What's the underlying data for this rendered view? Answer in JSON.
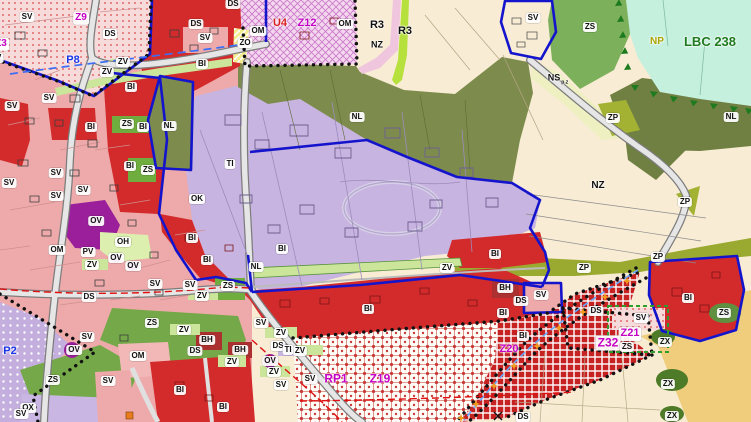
{
  "map": {
    "palette": {
      "residential_bi_red": "#d32b2b",
      "dark_red_bh": "#ad3030",
      "mixed_sv_pink": "#eeaaaa",
      "civic_ov_purple": "#9b1f9b",
      "technical_ti_lavender": "#c8b4e0",
      "forest_nl_olive": "#7d8c4c",
      "forest_nl_dark": "#6f8042",
      "greenery_zs": "#74a848",
      "park_zv_lightgreen": "#cbe69b",
      "agriculture_nz_cream": "#f8ecd4",
      "nature_np_mint": "#c6f0de",
      "zp_yellowgreen": "#9aaa30",
      "ns_pale_yellow": "#eef0c2",
      "orchard_tan": "#f0cd7c",
      "zx_dark_green": "#4e7b28",
      "boundary_blue": "#1414cc",
      "trail_star_orange": "#ef9b1d",
      "red_dash_line": "#e01010",
      "label_magenta": "#c400c4",
      "label_blue": "#1a35e6",
      "lbc_green": "#1e7a1e"
    },
    "trail_stars": [
      [
        627,
        281
      ],
      [
        605,
        297
      ],
      [
        583,
        312
      ],
      [
        559,
        328
      ],
      [
        537,
        346
      ],
      [
        514,
        366
      ],
      [
        494,
        386
      ],
      [
        476,
        404
      ],
      [
        461,
        418
      ]
    ],
    "labels": [
      {
        "t": "SV",
        "x": 27,
        "y": 17
      },
      {
        "t": "Z9",
        "x": 81,
        "y": 18,
        "c": "m",
        "fs": 10
      },
      {
        "t": "DS",
        "x": 233,
        "y": 4
      },
      {
        "t": "DS",
        "x": 196,
        "y": 24
      },
      {
        "t": "DS",
        "x": 110,
        "y": 34
      },
      {
        "t": "SV",
        "x": 205,
        "y": 38
      },
      {
        "t": "Z3",
        "x": 1,
        "y": 44,
        "c": "m",
        "fs": 10
      },
      {
        "t": "SV",
        "x": -4,
        "y": 58
      },
      {
        "t": "P8",
        "x": 73,
        "y": 61,
        "c": "b",
        "fs": 11,
        "box": false
      },
      {
        "t": "ZV",
        "x": 123,
        "y": 62
      },
      {
        "t": "ZV",
        "x": 107,
        "y": 72
      },
      {
        "t": "BI",
        "x": 202,
        "y": 64
      },
      {
        "t": "OM",
        "x": 258,
        "y": 31
      },
      {
        "t": "U4",
        "x": 280,
        "y": 24,
        "c": "r",
        "fs": 11,
        "box": false
      },
      {
        "t": "Z12",
        "x": 307,
        "y": 24,
        "c": "m",
        "fs": 11,
        "box": false
      },
      {
        "t": "OM",
        "x": 345,
        "y": 24
      },
      {
        "t": "ZO",
        "x": 245,
        "y": 43
      },
      {
        "t": "R3",
        "x": 377,
        "y": 26,
        "fs": 11,
        "box": false
      },
      {
        "t": "R3",
        "x": 405,
        "y": 32,
        "fs": 11,
        "box": false
      },
      {
        "t": "NZ",
        "x": 377,
        "y": 45,
        "fs": 9,
        "box": false
      },
      {
        "t": "SV",
        "x": 533,
        "y": 18
      },
      {
        "t": "ZS",
        "x": 590,
        "y": 27
      },
      {
        "t": "NP",
        "x": 657,
        "y": 42,
        "c": "y",
        "fs": 10,
        "box": false
      },
      {
        "t": "LBC 238",
        "x": 710,
        "y": 42,
        "c": "g",
        "fs": 13,
        "box": false
      },
      {
        "t": "NS",
        "x": 558,
        "y": 79,
        "fs": 9,
        "box": false,
        "sub": "p.z"
      },
      {
        "t": "BI",
        "x": 131,
        "y": 87
      },
      {
        "t": "SV",
        "x": 49,
        "y": 98
      },
      {
        "t": "SV",
        "x": 12,
        "y": 106
      },
      {
        "t": "BI",
        "x": 91,
        "y": 127
      },
      {
        "t": "ZS",
        "x": 127,
        "y": 124
      },
      {
        "t": "BI",
        "x": 143,
        "y": 127
      },
      {
        "t": "NL",
        "x": 169,
        "y": 126
      },
      {
        "t": "NL",
        "x": 357,
        "y": 117
      },
      {
        "t": "ZP",
        "x": 613,
        "y": 118
      },
      {
        "t": "NL",
        "x": 731,
        "y": 117
      },
      {
        "t": "BI",
        "x": 130,
        "y": 166
      },
      {
        "t": "ZS",
        "x": 148,
        "y": 170
      },
      {
        "t": "TI",
        "x": 230,
        "y": 164
      },
      {
        "t": "SV",
        "x": 56,
        "y": 173
      },
      {
        "t": "SV",
        "x": 9,
        "y": 183
      },
      {
        "t": "SV",
        "x": 83,
        "y": 190
      },
      {
        "t": "SV",
        "x": 56,
        "y": 196
      },
      {
        "t": "OK",
        "x": 197,
        "y": 199
      },
      {
        "t": "NZ",
        "x": 598,
        "y": 186,
        "fs": 10,
        "box": false
      },
      {
        "t": "ZP",
        "x": 685,
        "y": 202
      },
      {
        "t": "OV",
        "x": 96,
        "y": 221
      },
      {
        "t": "BI",
        "x": 192,
        "y": 238
      },
      {
        "t": "OH",
        "x": 123,
        "y": 242
      },
      {
        "t": "OM",
        "x": 57,
        "y": 250
      },
      {
        "t": "PV",
        "x": 88,
        "y": 252
      },
      {
        "t": "BI",
        "x": 282,
        "y": 249
      },
      {
        "t": "BI",
        "x": 495,
        "y": 254
      },
      {
        "t": "ZP",
        "x": 658,
        "y": 257
      },
      {
        "t": "BI",
        "x": 207,
        "y": 260
      },
      {
        "t": "ZV",
        "x": 92,
        "y": 265
      },
      {
        "t": "OV",
        "x": 116,
        "y": 258
      },
      {
        "t": "OV",
        "x": 133,
        "y": 266
      },
      {
        "t": "NL",
        "x": 256,
        "y": 267
      },
      {
        "t": "ZV",
        "x": 447,
        "y": 268
      },
      {
        "t": "ZP",
        "x": 584,
        "y": 268
      },
      {
        "t": "ZV",
        "x": 202,
        "y": 296
      },
      {
        "t": "DS",
        "x": 89,
        "y": 297
      },
      {
        "t": "SV",
        "x": 155,
        "y": 284
      },
      {
        "t": "SV",
        "x": 190,
        "y": 285
      },
      {
        "t": "ZS",
        "x": 228,
        "y": 286
      },
      {
        "t": "BH",
        "x": 505,
        "y": 288
      },
      {
        "t": "SV",
        "x": 541,
        "y": 295
      },
      {
        "t": "BI",
        "x": 688,
        "y": 298
      },
      {
        "t": "DS",
        "x": 521,
        "y": 301
      },
      {
        "t": "BI",
        "x": 368,
        "y": 309
      },
      {
        "t": "DS",
        "x": 596,
        "y": 311
      },
      {
        "t": "BI",
        "x": 503,
        "y": 313
      },
      {
        "t": "ZS",
        "x": 724,
        "y": 313
      },
      {
        "t": "SV",
        "x": 641,
        "y": 318
      },
      {
        "t": "SV",
        "x": 261,
        "y": 323
      },
      {
        "t": "ZS",
        "x": 152,
        "y": 323
      },
      {
        "t": "ZV",
        "x": 184,
        "y": 330
      },
      {
        "t": "ZV",
        "x": 281,
        "y": 333
      },
      {
        "t": "Z21",
        "x": 630,
        "y": 334,
        "c": "m",
        "fs": 11
      },
      {
        "t": "BI",
        "x": 523,
        "y": 336
      },
      {
        "t": "SV",
        "x": 87,
        "y": 337
      },
      {
        "t": "BH",
        "x": 207,
        "y": 340
      },
      {
        "t": "ZV",
        "x": 300,
        "y": 351
      },
      {
        "t": "Z32",
        "x": 608,
        "y": 343,
        "c": "m",
        "fs": 12
      },
      {
        "t": "ZS",
        "x": 627,
        "y": 347
      },
      {
        "t": "ZX",
        "x": 665,
        "y": 342
      },
      {
        "t": "DS",
        "x": 278,
        "y": 346
      },
      {
        "t": "TI",
        "x": 288,
        "y": 350
      },
      {
        "t": "Z20",
        "x": 509,
        "y": 350,
        "c": "m",
        "fs": 11,
        "box": false
      },
      {
        "t": "BH",
        "x": 240,
        "y": 350
      },
      {
        "t": "DS",
        "x": 195,
        "y": 351
      },
      {
        "t": "OM",
        "x": 138,
        "y": 356
      },
      {
        "t": "OV",
        "x": 74,
        "y": 350
      },
      {
        "t": "P2",
        "x": 10,
        "y": 352,
        "c": "b",
        "fs": 11,
        "box": false
      },
      {
        "t": "OV",
        "x": 270,
        "y": 361
      },
      {
        "t": "ZV",
        "x": 232,
        "y": 362
      },
      {
        "t": "ZV",
        "x": 274,
        "y": 372
      },
      {
        "t": "SV",
        "x": 310,
        "y": 379
      },
      {
        "t": "RP1",
        "x": 336,
        "y": 379,
        "c": "m",
        "fs": 12,
        "box": false
      },
      {
        "t": "Z19",
        "x": 380,
        "y": 379,
        "c": "m",
        "fs": 12,
        "box": false
      },
      {
        "t": "ZS",
        "x": 53,
        "y": 380
      },
      {
        "t": "SV",
        "x": 108,
        "y": 381
      },
      {
        "t": "SV",
        "x": 281,
        "y": 385
      },
      {
        "t": "ZX",
        "x": 668,
        "y": 384
      },
      {
        "t": "BI",
        "x": 180,
        "y": 390
      },
      {
        "t": "BI",
        "x": 223,
        "y": 407
      },
      {
        "t": "OX",
        "x": 28,
        "y": 408
      },
      {
        "t": "SV",
        "x": 21,
        "y": 414
      },
      {
        "t": "ZX",
        "x": 672,
        "y": 416
      },
      {
        "t": "DS",
        "x": 523,
        "y": 417
      }
    ]
  }
}
